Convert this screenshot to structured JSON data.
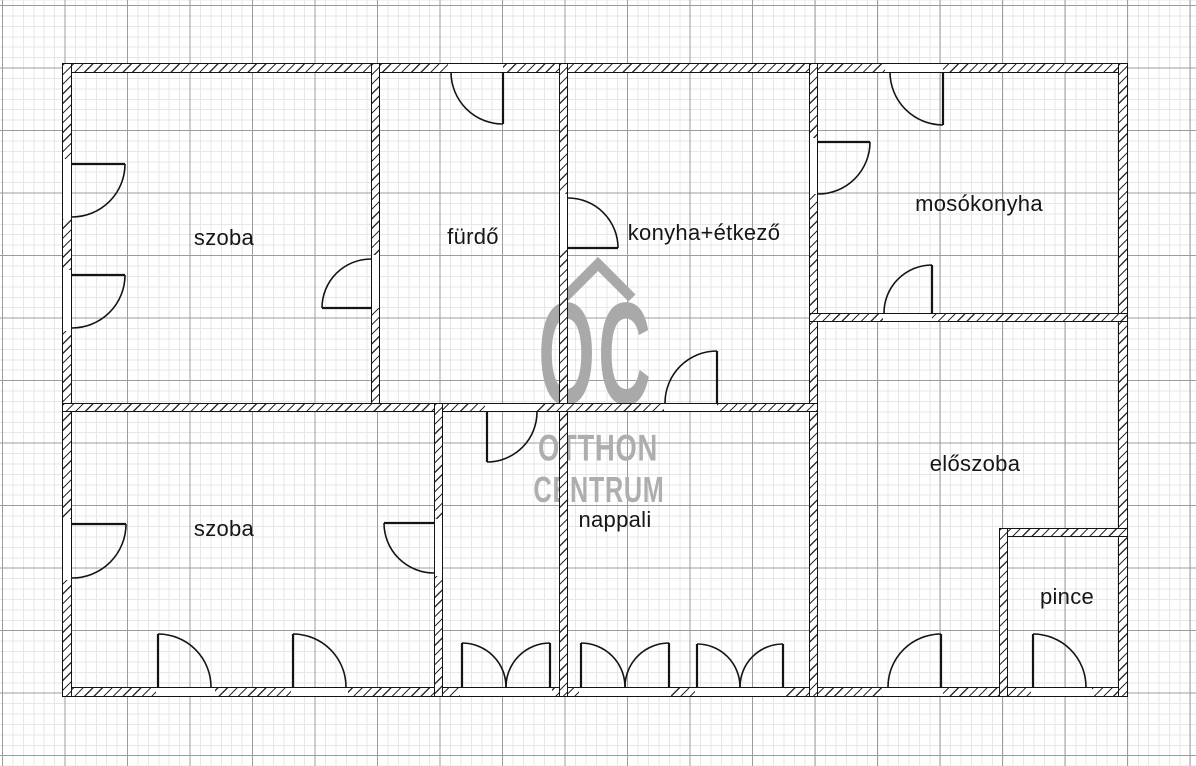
{
  "rooms": [
    {
      "id": "szoba-top",
      "label": "szoba"
    },
    {
      "id": "furdo",
      "label": "fürdő"
    },
    {
      "id": "konyha",
      "label": "konyha+étkező"
    },
    {
      "id": "mosokonyha",
      "label": "mosókonyha"
    },
    {
      "id": "szoba-bottom",
      "label": "szoba"
    },
    {
      "id": "nappali",
      "label": "nappali"
    },
    {
      "id": "eloszoba",
      "label": "előszoba"
    },
    {
      "id": "pince",
      "label": "pince"
    }
  ],
  "watermark": {
    "initials": "OC",
    "line1": "OTTHON",
    "line2": "CENTRUM",
    "roof_icon": "house-roof-icon"
  },
  "colors": {
    "wall": "#141414",
    "label_text": "#161616",
    "watermark_gray": "#a9a9a9",
    "grid_minor": "#e7e7e7",
    "grid_major": "#9c9c9c",
    "background": "#ffffff"
  }
}
